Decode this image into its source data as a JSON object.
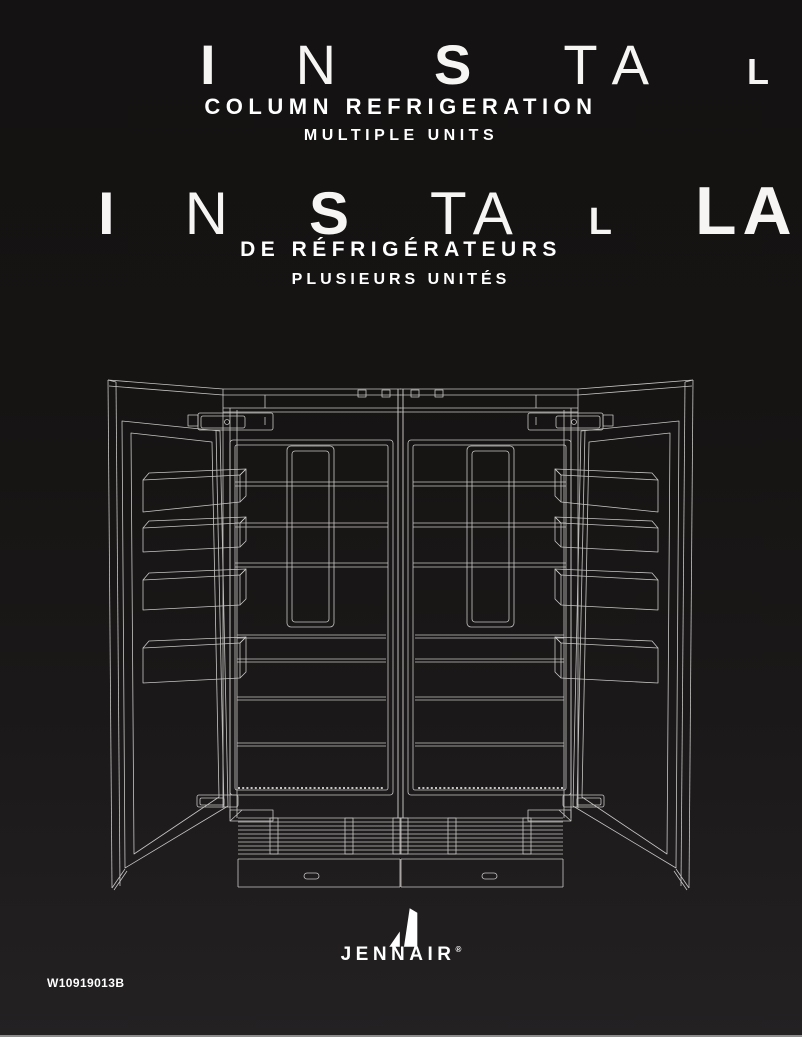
{
  "title_en": {
    "glyphs": [
      "I",
      "N",
      "S",
      "T",
      "A",
      "L"
    ],
    "line1": "COLUMN REFRIGERATION",
    "line2": "MULTIPLE UNITS"
  },
  "title_fr": {
    "glyphs": [
      "I",
      "N",
      "S",
      "T",
      "A",
      "L",
      "L",
      "A"
    ],
    "line1": "DE RÉFRIGÉRATEURS",
    "line2": "PLUSIEURS UNITÉS"
  },
  "brand": {
    "wordmark": "JENNAIR",
    "registered": "®"
  },
  "footer": {
    "part_number": "W10919013B"
  },
  "illustration": {
    "name": "two-column-refrigerators-doors-open-line-art"
  },
  "colors": {
    "background_top": "#141212",
    "background_bottom": "#232122",
    "text": "#ffffff",
    "line_art": "#c8c6c5",
    "bottom_bar": "#8c8c8c"
  }
}
